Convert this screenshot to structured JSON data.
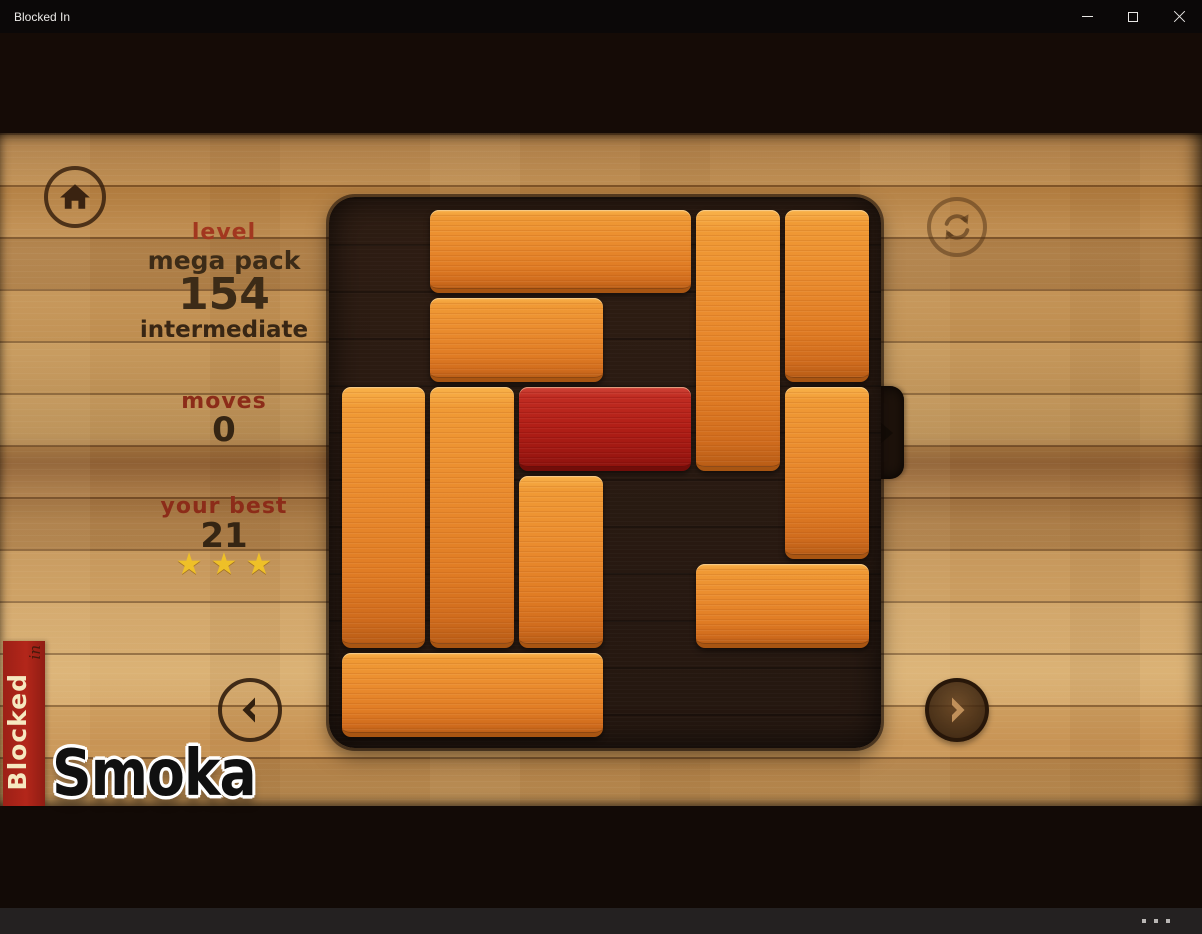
{
  "window": {
    "title": "Blocked In",
    "controls": [
      "minimize",
      "maximize",
      "close"
    ]
  },
  "hud": {
    "level_label": "level",
    "pack": "mega pack",
    "level_number": "154",
    "difficulty": "intermediate",
    "moves_label": "moves",
    "moves_value": "0",
    "best_label": "your best",
    "best_value": "21",
    "stars": 3
  },
  "board": {
    "grid": {
      "cols": 6,
      "rows": 6
    },
    "exit": {
      "side": "right",
      "row": 2
    },
    "blocks": [
      {
        "col": 1,
        "row": 0,
        "len": 3,
        "dir": "h",
        "color": "orange"
      },
      {
        "col": 4,
        "row": 0,
        "len": 3,
        "dir": "v",
        "color": "orange"
      },
      {
        "col": 5,
        "row": 0,
        "len": 2,
        "dir": "v",
        "color": "orange"
      },
      {
        "col": 1,
        "row": 1,
        "len": 2,
        "dir": "h",
        "color": "orange"
      },
      {
        "col": 0,
        "row": 2,
        "len": 3,
        "dir": "v",
        "color": "orange"
      },
      {
        "col": 1,
        "row": 2,
        "len": 3,
        "dir": "v",
        "color": "orange"
      },
      {
        "col": 2,
        "row": 2,
        "len": 2,
        "dir": "h",
        "color": "red",
        "target": true
      },
      {
        "col": 5,
        "row": 2,
        "len": 2,
        "dir": "v",
        "color": "orange"
      },
      {
        "col": 2,
        "row": 3,
        "len": 2,
        "dir": "v",
        "color": "orange"
      },
      {
        "col": 4,
        "row": 4,
        "len": 2,
        "dir": "h",
        "color": "orange"
      },
      {
        "col": 0,
        "row": 5,
        "len": 3,
        "dir": "h",
        "color": "orange"
      }
    ]
  },
  "buttons": {
    "home": "home",
    "restart": "restart-level",
    "prev": "previous-level",
    "next": "next-level",
    "more": "more-options"
  },
  "branding": {
    "banner_title": "Blocked",
    "banner_sub": "in",
    "watermark": "Smoka"
  },
  "icons": {
    "star": "★",
    "home": "home-icon",
    "refresh": "refresh-icon",
    "chevron_left": "chevron-left-icon",
    "chevron_right": "chevron-right-icon",
    "exit_arrow": "exit-arrow-icon"
  },
  "colors": {
    "banner_red": "#b3261a",
    "block_orange": "#e8872b",
    "block_red": "#b21f17",
    "star_gold": "#eec028",
    "board_dark": "#241710",
    "wood_mid": "#bd8c4e",
    "hud_red": "#8c2c19",
    "hud_brown": "#3c2b17"
  }
}
